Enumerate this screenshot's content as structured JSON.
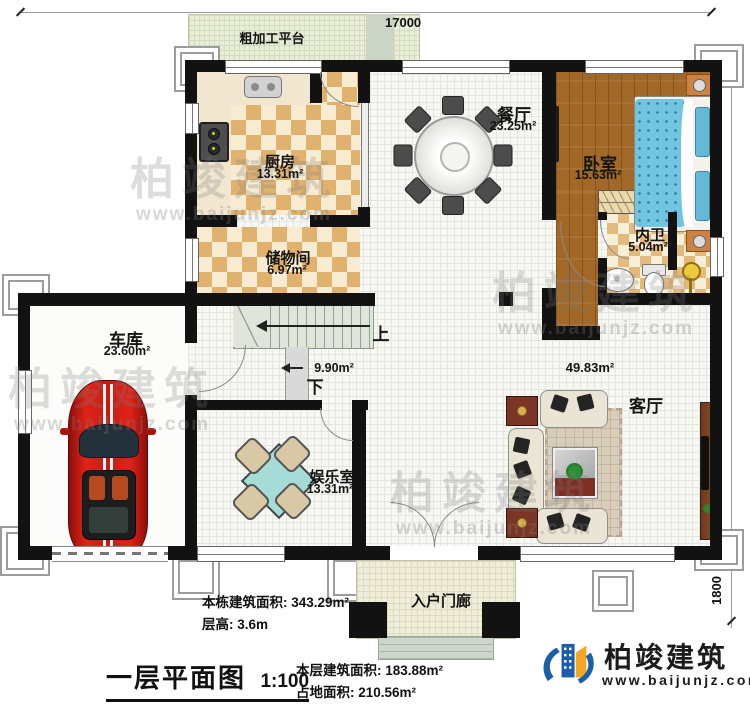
{
  "dimensions": {
    "top": "17000",
    "right": "11800",
    "right_lower": "1800"
  },
  "rooms": {
    "platform": {
      "name": "粗加工平台"
    },
    "kitchen": {
      "name": "厨房",
      "area": "13.31m²"
    },
    "storage": {
      "name": "储物间",
      "area": "6.97m²"
    },
    "dining": {
      "name": "餐厅",
      "area": "23.25m²"
    },
    "bedroom": {
      "name": "卧室",
      "area": "15.63m²"
    },
    "ensuite": {
      "name": "内卫",
      "area": "5.04m²"
    },
    "garage": {
      "name": "车库",
      "area": "23.60m²"
    },
    "entertainment": {
      "name": "娱乐室",
      "area": "13.31m²"
    },
    "living": {
      "name": "客厅",
      "area": "49.83m²"
    },
    "porch": {
      "name": "入户门廊"
    },
    "stairs": {
      "up": "上",
      "down": "下",
      "area": "9.90m²"
    }
  },
  "footer": {
    "building_area_label": "本栋建筑面积: 343.29m²",
    "floor_height_label": "层高: 3.6m",
    "title": "一层平面图",
    "scale": "1:100",
    "floor_area_label": "本层建筑面积: 183.88m²",
    "footprint_label": "占地面积: 210.56m²"
  },
  "brand": {
    "name": "柏竣建筑",
    "url": "www.baijunjz.com"
  },
  "watermark": {
    "name": "柏竣建筑",
    "url": "www.baijunjz.com"
  },
  "colors": {
    "wall": "#121212",
    "checker_tan": "#e0b26e",
    "wood": "#a26827",
    "accent_blue": "#1a5fa8",
    "accent_orange": "#f5a623",
    "bed_blue": "#72c5e1",
    "car_red": "#c81a12"
  }
}
